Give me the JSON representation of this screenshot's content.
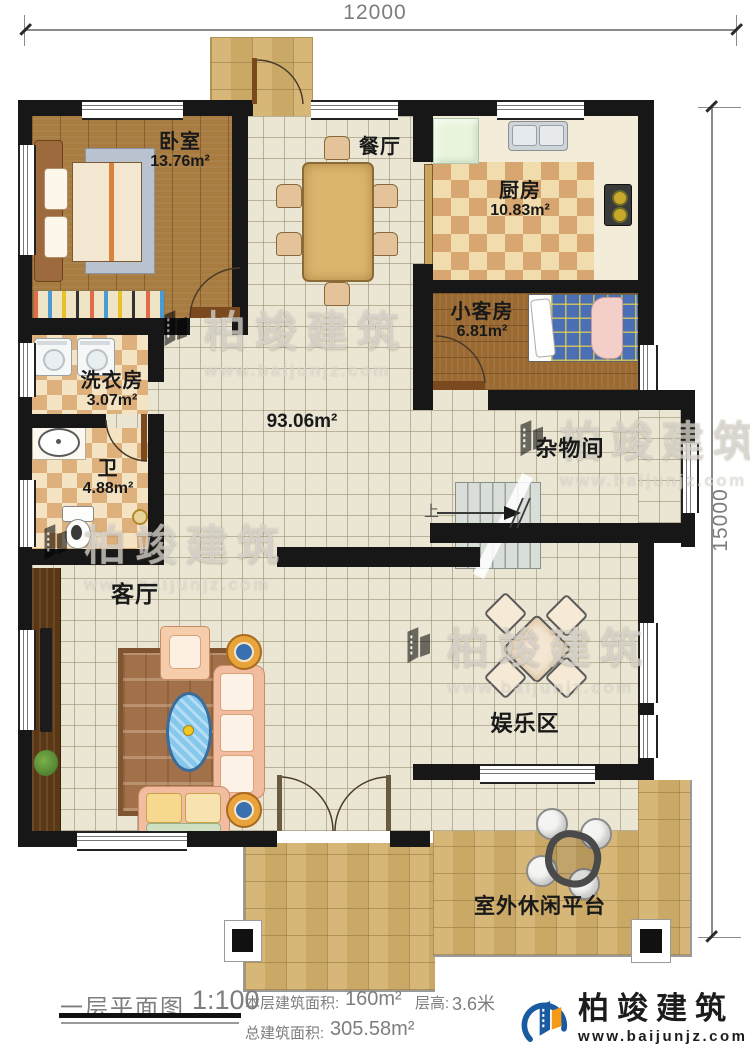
{
  "plan": {
    "dimensions": {
      "width_label": "12000",
      "height_label": "15000"
    },
    "rooms": {
      "bedroom": {
        "name": "卧室",
        "area": "13.76m²"
      },
      "dining": {
        "name": "餐厅"
      },
      "kitchen": {
        "name": "厨房",
        "area": "10.83m²"
      },
      "guest_room": {
        "name": "小客房",
        "area": "6.81m²"
      },
      "laundry": {
        "name": "洗衣房",
        "area": "3.07m²"
      },
      "bathroom": {
        "name": "卫",
        "area": "4.88m²"
      },
      "hall": {
        "area": "93.06m²"
      },
      "storage": {
        "name": "杂物间"
      },
      "living_room": {
        "name": "客厅"
      },
      "entertainment": {
        "name": "娱乐区"
      },
      "terrace": {
        "name": "室外休闲平台"
      }
    },
    "stairs": {
      "up_label": "上"
    }
  },
  "title_block": {
    "title": "一层平面图",
    "scale": "1:100",
    "floor_area_label": "本层建筑面积:",
    "floor_area_value": "160m²",
    "height_label": "层高:",
    "height_value": "3.6米",
    "total_area_label": "总建筑面积:",
    "total_area_value": "305.58m²"
  },
  "branding": {
    "company": "柏竣建筑",
    "website": "www.baijunjz.com"
  },
  "watermark": {
    "company": "柏竣建筑",
    "website": "www.baijunjz.com"
  },
  "colors": {
    "logo_blue": "#1a5aa0",
    "logo_orange": "#f49a17",
    "wall": "#171717"
  }
}
